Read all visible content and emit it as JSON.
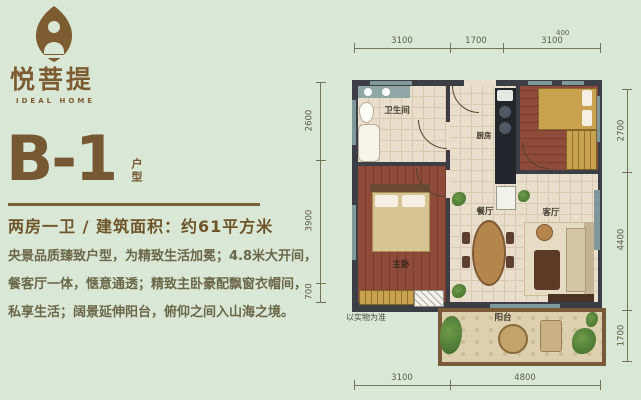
{
  "colors": {
    "background": "#d9e8d6",
    "brand_brown": "#7a5c32",
    "wall": "#3b3f45",
    "wood_floor": "#8e4b3a",
    "tile_floor": "#e9decb",
    "furniture_gold": "#c8a24f",
    "dimension_olive": "#5d5d46"
  },
  "logo": {
    "name": "悦菩提",
    "tagline": "IDEAL HOME"
  },
  "unit": {
    "code": "B-1",
    "suffix": "户型"
  },
  "spec": "两房一卫 / 建筑面积：约61平方米",
  "description": {
    "line1": "央景品质臻致户型，为精致生活加冕；4.8米大开间，",
    "line2": "餐客厅一体，惬意通透；精致主卧豪配飘窗衣帽间，",
    "line3": "私享生活；阔景延伸阳台，俯仰之间入山海之境。"
  },
  "plan": {
    "disclaimer": "以实物为准",
    "rooms": {
      "bathroom": "卫生间",
      "kitchen": "厨房",
      "dining": "餐厅",
      "living": "客厅",
      "master": "主卧",
      "balcony": "阳台"
    },
    "dimensions": {
      "top": [
        "3100",
        "1700",
        "3100"
      ],
      "top_note": "400",
      "bottom": [
        "3100",
        "4800"
      ],
      "left": [
        "2600",
        "3900",
        "700"
      ],
      "right": [
        "2700",
        "4400",
        "1700"
      ]
    }
  }
}
